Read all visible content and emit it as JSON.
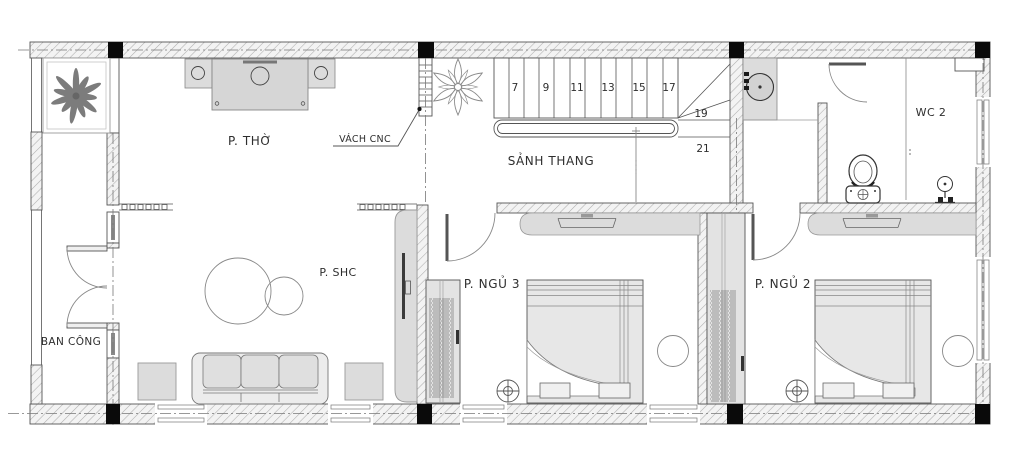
{
  "drawing": {
    "type": "architectural-floor-plan",
    "rooms": {
      "worship": "P. THỜ",
      "stair_hall": "SẢNH THANG",
      "wc2": "WC 2",
      "living": "P. SHC",
      "bedroom3": "P. NGỦ 3",
      "bedroom2": "P. NGỦ 2",
      "balcony": "BAN CÔNG"
    },
    "annotations": {
      "cnc_partition": "VÁCH CNC"
    },
    "stairs": {
      "numbers": [
        "7",
        "9",
        "11",
        "13",
        "15",
        "17",
        "19",
        "21"
      ]
    },
    "colors": {
      "line": "#4a4a4a",
      "wall_hatch_bg": "#f3f3f3",
      "wall_hatch_line": "#aeaeae",
      "furniture_fill": "#dcdcdc",
      "column": "#0a0a0a",
      "background": "#ffffff"
    }
  }
}
